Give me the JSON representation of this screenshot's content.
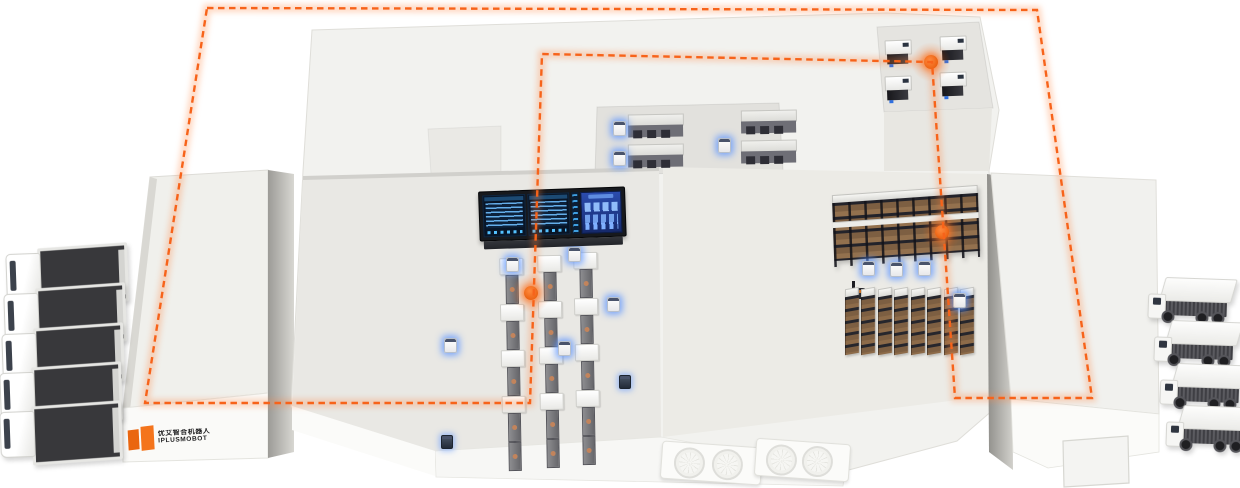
{
  "brand": {
    "logo_text_top": "优艾智合机器人",
    "logo_text_bottom": "IPLUSMOBOT",
    "logo_color": "#ee6c17"
  },
  "route": {
    "color": "#f7631a",
    "line_style": "dashed",
    "waypoint_count": 3
  },
  "scene": {
    "trucks_left": 5,
    "trucks_right": 4,
    "production_lines": 3,
    "stations_per_line": 4,
    "workstations_top_center": 4,
    "workstations_top_right": 4,
    "rack_rows": 8,
    "long_rack_count": 1,
    "agv_count_white": 12,
    "agv_count_dark": 2,
    "dock_fan_count": 4
  },
  "screen": {
    "panels": [
      "data-table-left",
      "data-table-right",
      "kpi-dashboard"
    ],
    "bg_color": "#081527",
    "accent_color": "#53c1ff",
    "kpi_bg_color": "#24439f"
  },
  "colors": {
    "building_top": "#f2f2ef",
    "floor_center": "#e9e8e4",
    "floor_right": "#ecebe6",
    "recess_floor": "#e2e1dd",
    "trailer_dark": "#38383b",
    "cargo_box": "#7d5f42",
    "agv_glow": "#5f96ff"
  }
}
